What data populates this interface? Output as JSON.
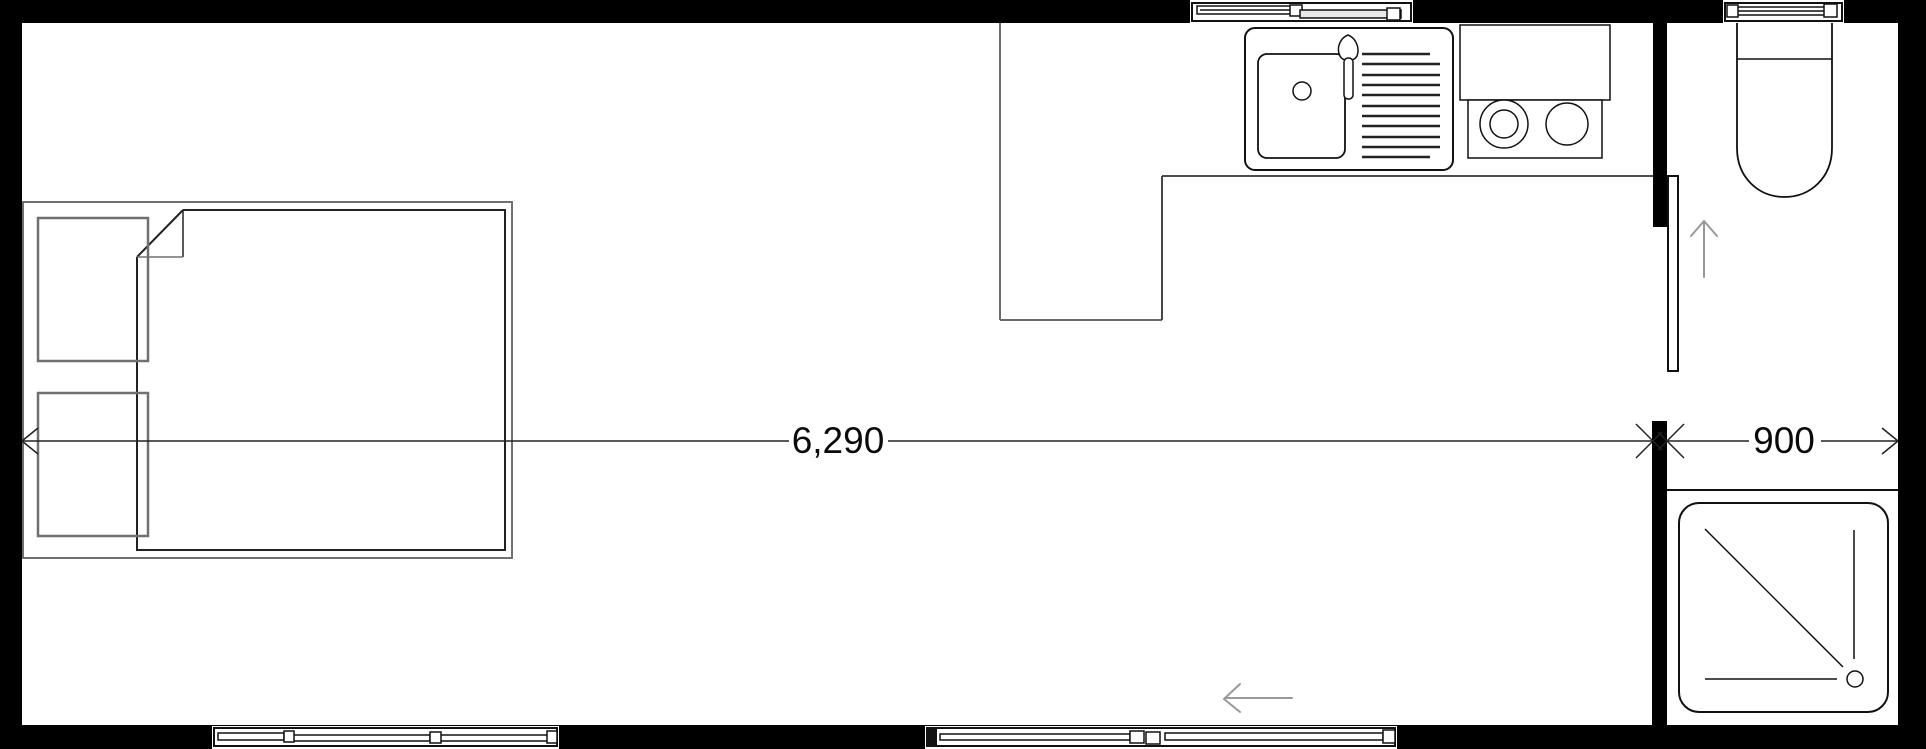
{
  "drawing": {
    "type": "floor-plan",
    "description_icons": [
      "bed-icon",
      "pillow-icon",
      "sink-icon",
      "faucet-icon",
      "drainboard-icon",
      "cooktop-icon",
      "range-hood-icon",
      "toilet-icon",
      "shower-tray-icon",
      "shower-drain-icon",
      "door-leaf-icon",
      "door-swing-arrow-icon",
      "entry-arrow-icon",
      "window-icon"
    ],
    "dimensions": {
      "main": {
        "label": "6,290"
      },
      "bath": {
        "label": "900"
      }
    },
    "colors": {
      "wall": "#000000",
      "line": "#111111",
      "furniture_gray": "#707070",
      "arrow_gray": "#999999",
      "background": "#ffffff"
    }
  }
}
